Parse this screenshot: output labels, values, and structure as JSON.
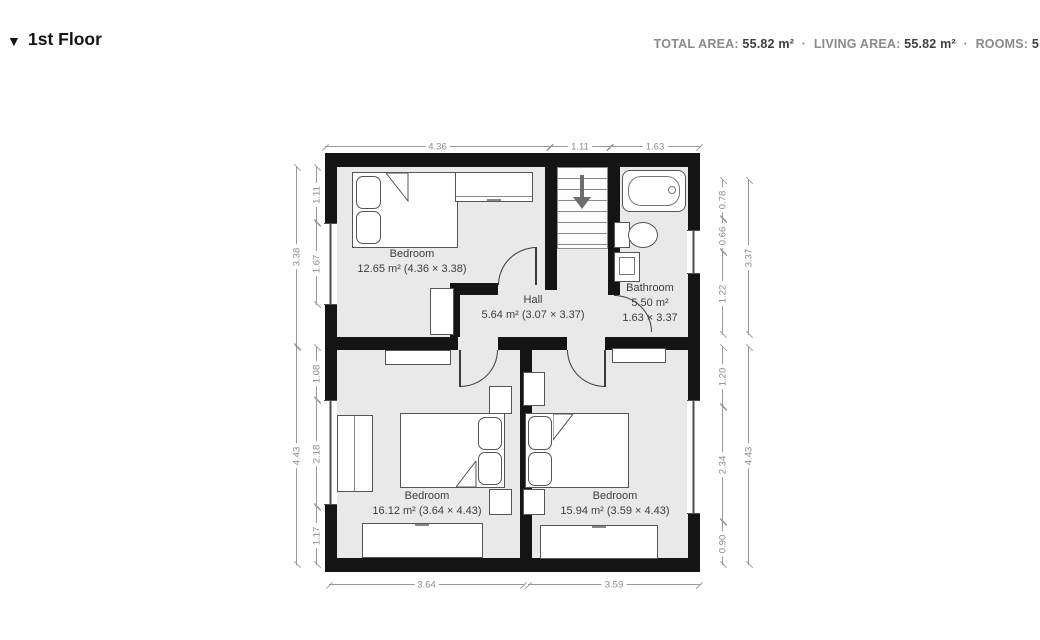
{
  "header": {
    "collapse_icon": "▼",
    "title": "1st Floor",
    "stats": {
      "total_area_label": "TOTAL AREA:",
      "total_area_value": "55.82 m²",
      "living_area_label": "LIVING AREA:",
      "living_area_value": "55.82 m²",
      "rooms_label": "ROOMS:",
      "rooms_value": "5",
      "separator": "·"
    }
  },
  "floorplan": {
    "rooms": {
      "bedroom_top_left": {
        "name": "Bedroom",
        "details": "12.65 m² (4.36 × 3.38)"
      },
      "hall": {
        "name": "Hall",
        "details": "5.64 m² (3.07 × 3.37)"
      },
      "bathroom": {
        "name": "Bathroom",
        "area": "5.50 m²",
        "size": "1.63 × 3.37"
      },
      "bedroom_bottom_left": {
        "name": "Bedroom",
        "details": "16.12 m² (3.64 × 4.43)"
      },
      "bedroom_bottom_right": {
        "name": "Bedroom",
        "details": "15.94 m² (3.59 × 4.43)"
      }
    },
    "dimensions": {
      "top": [
        "4.36",
        "1.11",
        "1.63"
      ],
      "bottom": [
        "3.64",
        "3.59"
      ],
      "left_outer": [
        "3.38",
        "4.43"
      ],
      "left_inner": [
        "1.11",
        "1.67",
        "1.08",
        "2.18",
        "1.17"
      ],
      "right_outer": [
        "3.37",
        "4.43"
      ],
      "right_inner": [
        "0.78",
        "0.66",
        "1.22",
        "1.20",
        "2.34",
        "0.90"
      ]
    },
    "colors": {
      "wall": "#141414",
      "floor": "#e9e9e9",
      "furniture_outline": "#555555",
      "dimension_line": "#999999",
      "dimension_text": "#8c8c8c",
      "room_label": "#3d3d3d"
    },
    "icons": {
      "stairs_direction": "down-arrow"
    }
  }
}
